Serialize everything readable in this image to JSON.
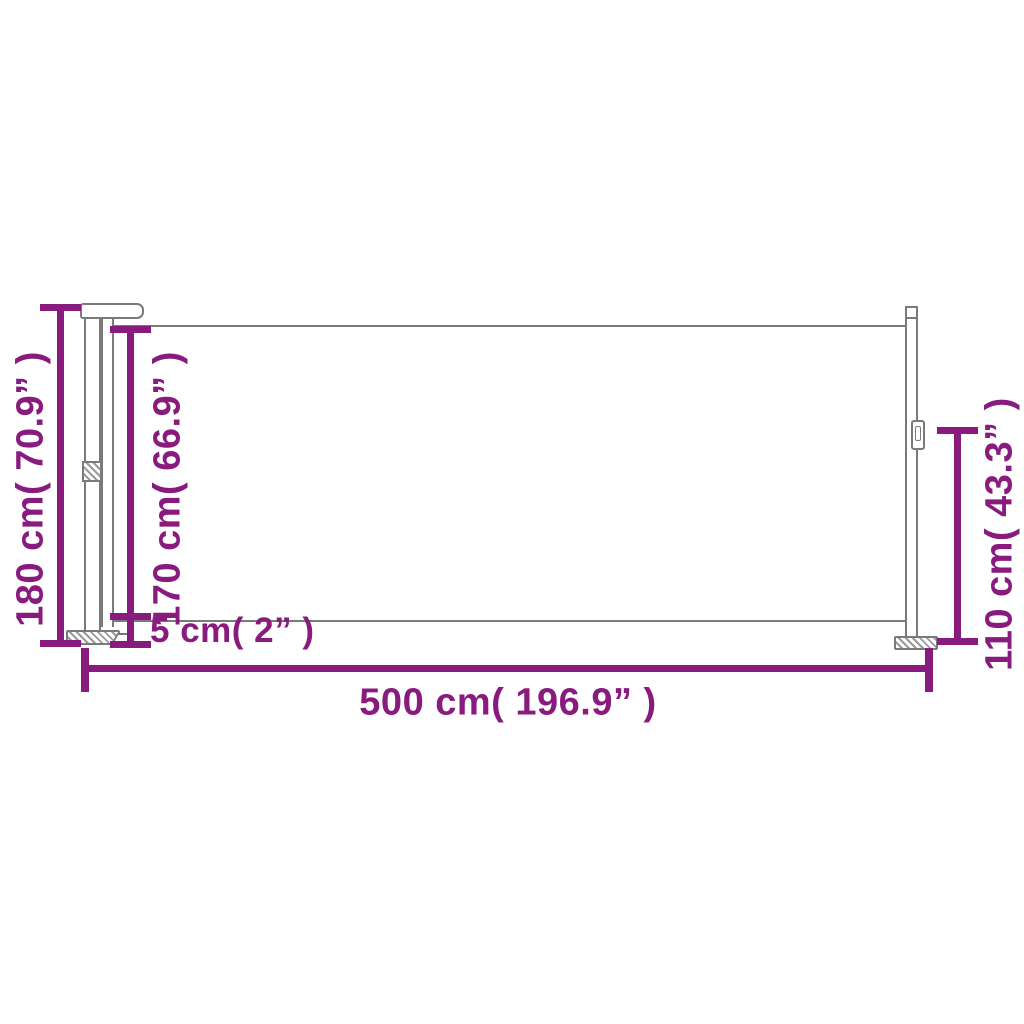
{
  "colors": {
    "accent": "#8A1B7E",
    "line": "#7a7a7a",
    "background": "#ffffff"
  },
  "dimensions": [
    {
      "id": "total-height",
      "label": "180 cm( 70.9” )",
      "cm": 180,
      "inch": 70.9,
      "orientation": "vertical"
    },
    {
      "id": "fabric-height",
      "label": "170 cm( 66.9” )",
      "cm": 170,
      "inch": 66.9,
      "orientation": "vertical"
    },
    {
      "id": "ground-gap",
      "label": "5 cm( 2” )",
      "cm": 5,
      "inch": 2,
      "orientation": "vertical"
    },
    {
      "id": "total-length",
      "label": "500 cm( 196.9” )",
      "cm": 500,
      "inch": 196.9,
      "orientation": "horizontal"
    },
    {
      "id": "end-post-height",
      "label": "110 cm( 43.3” )",
      "cm": 110,
      "inch": 43.3,
      "orientation": "vertical"
    }
  ]
}
